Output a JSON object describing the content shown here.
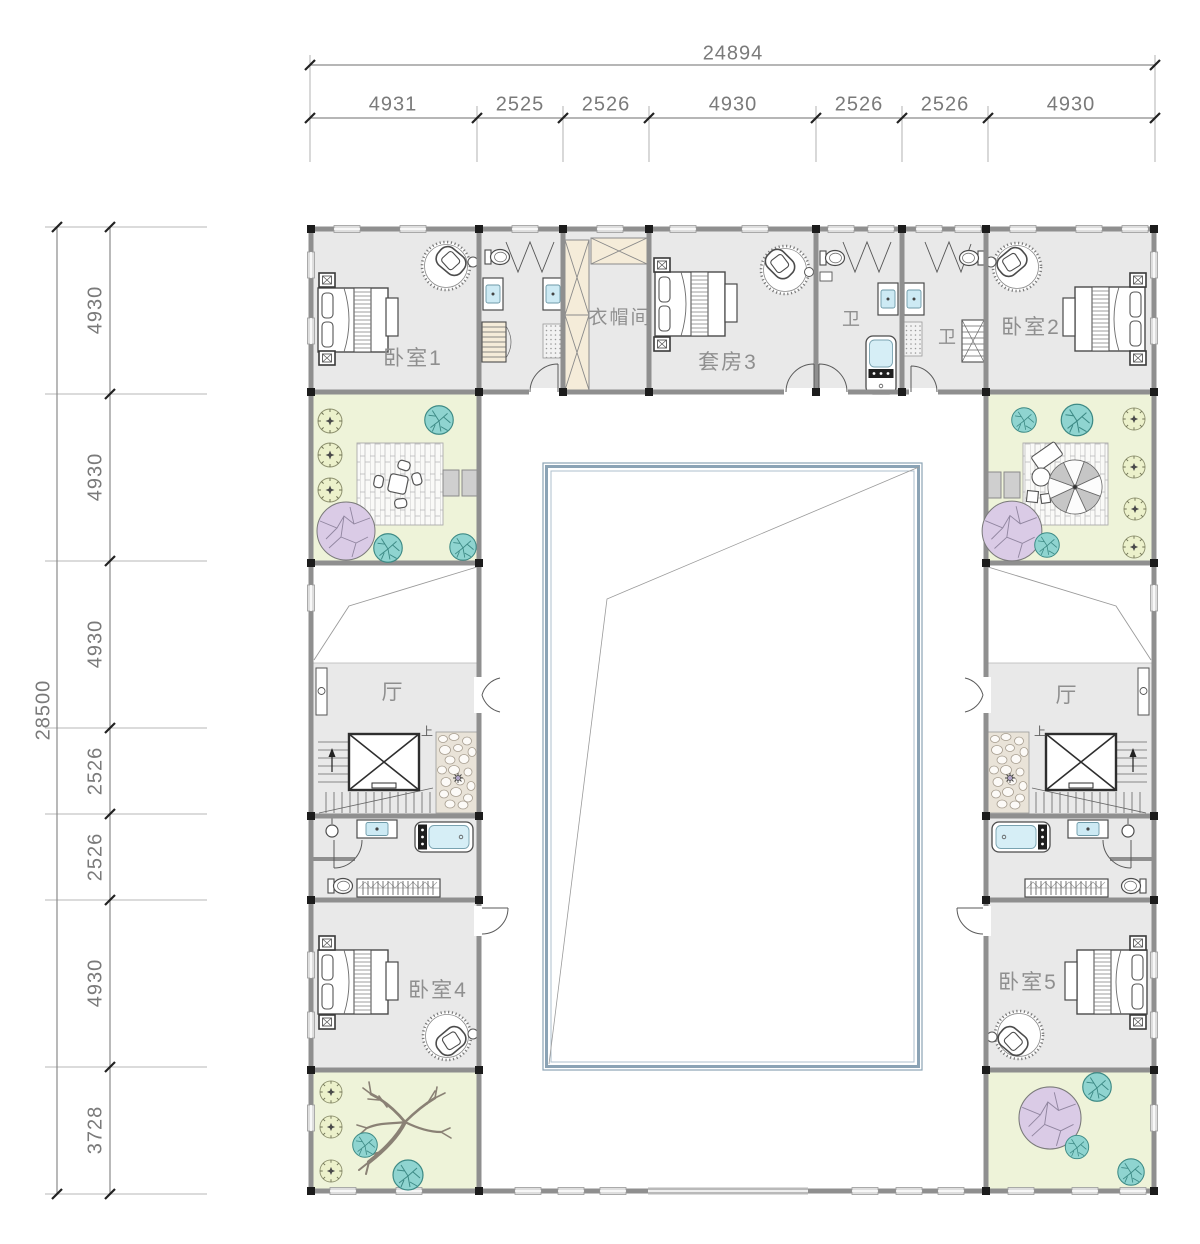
{
  "drawing": {
    "type": "courtyard-house-floor-plan",
    "dimensions_top": {
      "total": "24894",
      "segments": [
        "4931",
        "2525",
        "2526",
        "4930",
        "2526",
        "2526",
        "4930"
      ]
    },
    "dimensions_left": {
      "total": "28500",
      "segments": [
        "4930",
        "4930",
        "4930",
        "2526",
        "2526",
        "4930",
        "3728"
      ]
    },
    "labels": {
      "bedroom1": "卧室1",
      "bedroom2": "卧室2",
      "suite3": "套房3",
      "cloakroom": "衣帽间",
      "bath1": "卫",
      "bath2": "卫",
      "hall_left": "厅",
      "hall_right": "厅",
      "up_left": "上",
      "up_right": "上",
      "bedroom4": "卧室4",
      "bedroom5": "卧室5"
    },
    "colors": {
      "room_fill": "#e9e9e9",
      "garden_fill": "#eef3d9",
      "wall": "#8f8f8f",
      "tree_teal": "#8fd4d0",
      "tree_green": "#ecf1cb",
      "tree_purple": "#dacbe6",
      "pool_border": "#8ba3b5",
      "fixture_water": "#cdeaf4",
      "wardrobe": "#f5ecd9",
      "pebble_bg": "#e9e3d8",
      "dim_text": "#7a7a7a",
      "label_text": "#8f8f8f"
    }
  }
}
